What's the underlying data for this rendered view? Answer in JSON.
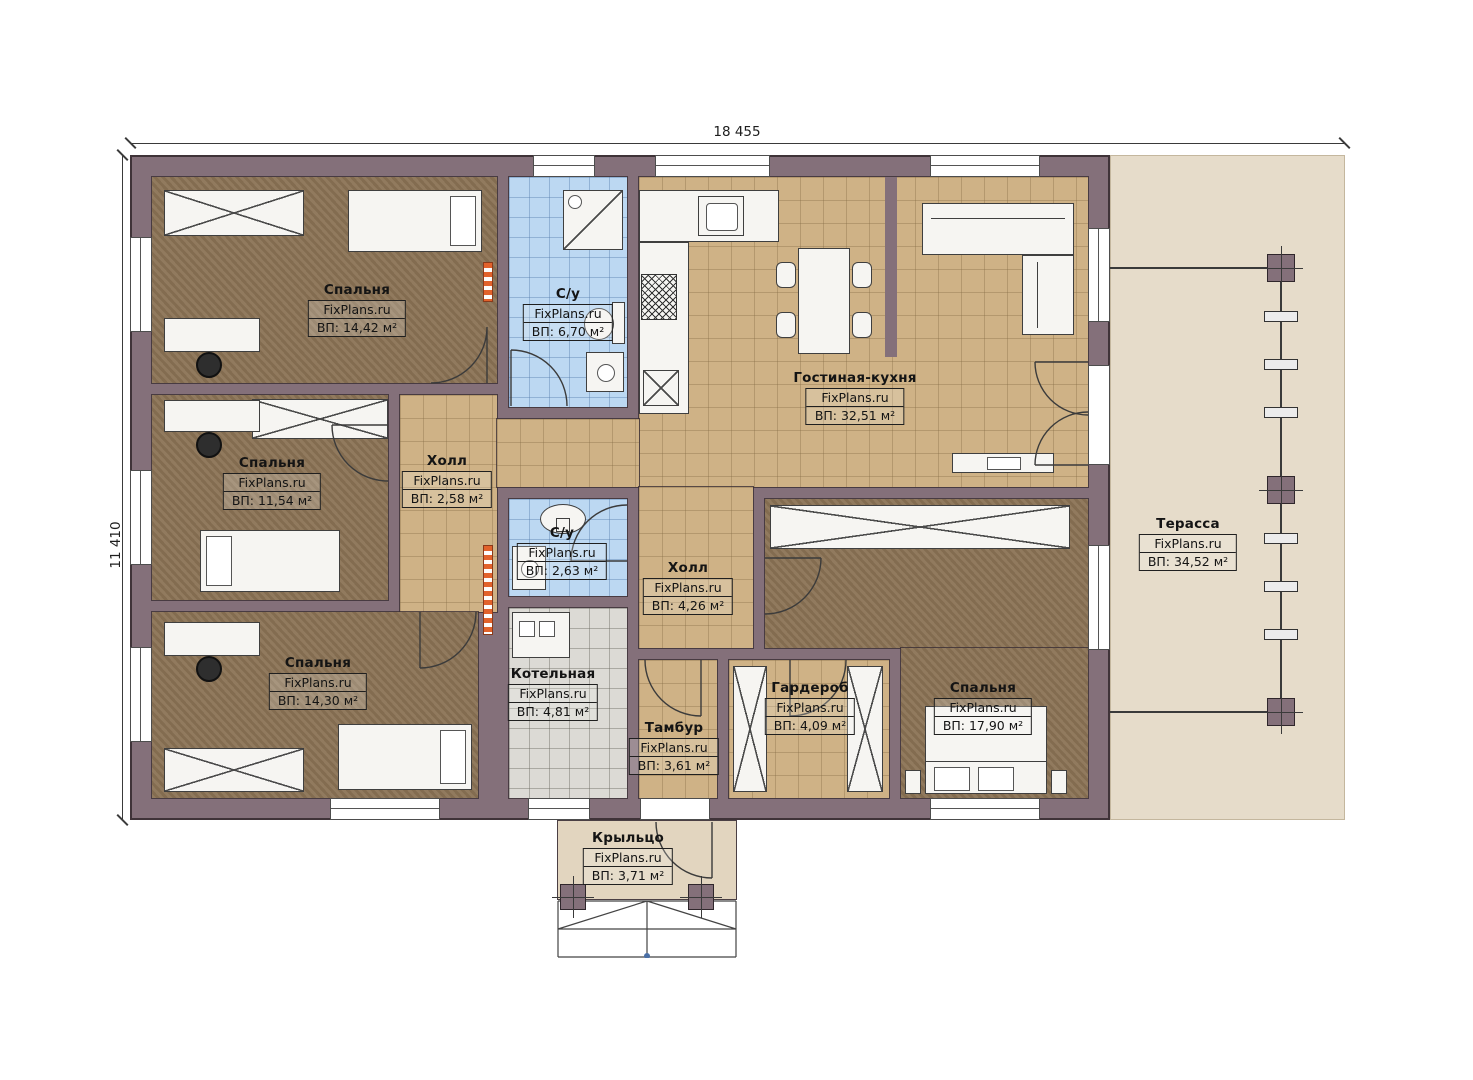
{
  "plan": {
    "width_label": "18 455",
    "height_label": "11 410"
  },
  "brand": "FixPlans.ru",
  "colors": {
    "wall": "#84707a",
    "bedroom_floor": "#8b7355",
    "tile_beige": "#cfb286",
    "tile_blue": "#bcd8f2",
    "tile_gray": "#dcdad5",
    "terrace_floor": "#e6dcca",
    "porch_floor": "#e2d5bf",
    "radiator_accent": "#e2622b"
  },
  "rooms": [
    {
      "id": "bedroom-1",
      "name": "Спальня",
      "brand": "FixPlans.ru",
      "area": "ВП: 14,42 м²"
    },
    {
      "id": "bedroom-2",
      "name": "Спальня",
      "brand": "FixPlans.ru",
      "area": "ВП: 11,54 м²"
    },
    {
      "id": "bedroom-3",
      "name": "Спальня",
      "brand": "FixPlans.ru",
      "area": "ВП: 14,30 м²"
    },
    {
      "id": "bathroom-1",
      "name": "С/у",
      "brand": "FixPlans.ru",
      "area": "ВП: 6,70 м²"
    },
    {
      "id": "hall-1",
      "name": "Холл",
      "brand": "FixPlans.ru",
      "area": "ВП: 2,58 м²"
    },
    {
      "id": "living-kitchen",
      "name": "Гостиная-кухня",
      "brand": "FixPlans.ru",
      "area": "ВП: 32,51 м²"
    },
    {
      "id": "bathroom-2",
      "name": "С/у",
      "brand": "FixPlans.ru",
      "area": "ВП: 2,63 м²"
    },
    {
      "id": "hall-2",
      "name": "Холл",
      "brand": "FixPlans.ru",
      "area": "ВП: 4,26 м²"
    },
    {
      "id": "boiler-room",
      "name": "Котельная",
      "brand": "FixPlans.ru",
      "area": "ВП: 4,81 м²"
    },
    {
      "id": "vestibule",
      "name": "Тамбур",
      "brand": "FixPlans.ru",
      "area": "ВП: 3,61 м²"
    },
    {
      "id": "wardrobe",
      "name": "Гардероб",
      "brand": "FixPlans.ru",
      "area": "ВП: 4,09 м²"
    },
    {
      "id": "bedroom-4",
      "name": "Спальня",
      "brand": "FixPlans.ru",
      "area": "ВП: 17,90 м²"
    },
    {
      "id": "terrace",
      "name": "Терасса",
      "brand": "FixPlans.ru",
      "area": "ВП: 34,52 м²"
    },
    {
      "id": "porch",
      "name": "Крыльцо",
      "brand": "FixPlans.ru",
      "area": "ВП: 3,71 м²"
    }
  ]
}
